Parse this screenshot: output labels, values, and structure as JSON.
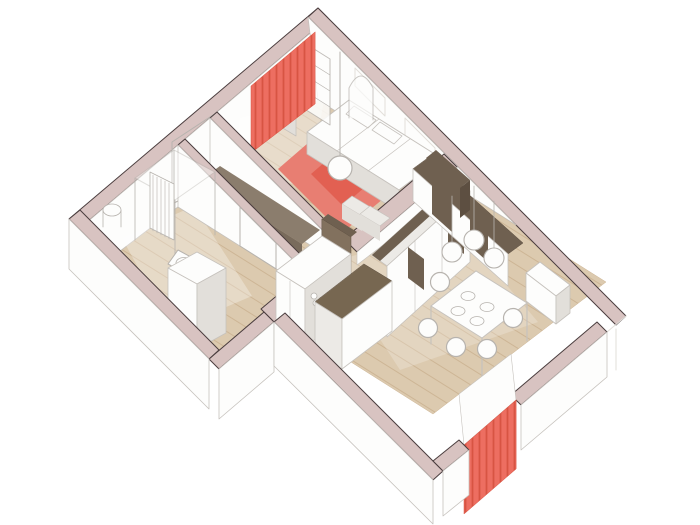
{
  "palette": {
    "wallTop": "#d8c3c1",
    "wallEdge": "#4a3d3e",
    "outline": "#c6c2bd",
    "shade": "#e2dfda",
    "lightGray": "#eceae6",
    "white": "#fdfdfc",
    "woodBase": "#dccaaf",
    "woodLine": "#cdb595",
    "rug": "#e87e72",
    "rugDark": "#e26052",
    "red": "#ed6e61",
    "redStripe": "#d85443",
    "brown": "#6f6050",
    "brownLight": "#82715e",
    "brownMid": "#5d4f41",
    "benchTop": "#8b7d6d",
    "benchFront": "#796b5c",
    "islandTop": "#776751",
    "gray": "#b7b3ae",
    "wash": "#ffffff"
  },
  "scene": [
    {
      "n": "floor-bedroom",
      "k": "poly",
      "p": "318,100 444,180 344,257 217,177",
      "f": "url(#wood)",
      "s": "$woodLine",
      "w": 0.5
    },
    {
      "n": "floor-hallway",
      "k": "poly",
      "p": "217,177 344,257 305,287 178,207",
      "f": "url(#wood)",
      "s": "$woodLine",
      "w": 0.5
    },
    {
      "n": "floor-bathroom",
      "k": "poly",
      "p": "178,207 305,287 217,354 90,274",
      "f": "url(#wood)",
      "s": "$woodLine",
      "w": 0.5
    },
    {
      "n": "floor-living-room",
      "k": "poly",
      "p": "444,180 606,282 433,414 272,312",
      "f": "url(#wood)",
      "s": "$woodLine",
      "w": 0.5
    },
    {
      "n": "wall-upper-left-top",
      "k": "poly",
      "p": "318,8 69,219 79,229 328,18",
      "f": "$wallTop",
      "s": "$wallEdge",
      "w": 1
    },
    {
      "n": "wall-upper-left-face",
      "k": "poly",
      "p": "328,18 79,229 90,274 318,100",
      "f": "$white",
      "s": "$outline",
      "w": 0.8
    },
    {
      "n": "entry-door-frame",
      "k": "poly",
      "p": "216,113 172,142 172,204 216,182",
      "f": "none",
      "s": "$gray",
      "w": 1
    },
    {
      "n": "entry-door-leaf",
      "k": "line",
      "p": "214,183 193,207",
      "s": "$gray",
      "w": 1.2
    },
    {
      "n": "wall-upper-right-top",
      "k": "poly",
      "p": "318,8 626,316 616,325 308,17",
      "f": "$wallTop",
      "s": "$wallEdge",
      "w": 1
    },
    {
      "n": "wall-upper-right-face",
      "k": "poly",
      "p": "308,17 516,225 318,100",
      "f": "$white",
      "s": "$outline",
      "w": 0.8
    },
    {
      "n": "window-frame-1",
      "k": "poly",
      "p": "355,68 385,98 385,116 355,86",
      "f": "none",
      "s": "$shade",
      "w": 1
    },
    {
      "n": "window-frame-2",
      "k": "poly",
      "p": "405,118 435,148 435,166 405,136",
      "f": "none",
      "s": "$shade",
      "w": 1
    },
    {
      "n": "corner-glass-lines",
      "k": "path",
      "p": "M626,316L607,332M616,329L616,370M600,342L600,382",
      "s": "$shade",
      "w": 1
    },
    {
      "n": "light-wash-bedroom",
      "k": "poly",
      "p": "240,118 325,95 308,188 232,168",
      "f": "$wash",
      "o": 0.35
    },
    {
      "n": "light-wash-bathroom",
      "k": "poly",
      "p": "122,238 194,206 252,296 172,330",
      "f": "$wash",
      "o": 0.3
    },
    {
      "n": "light-wash-living",
      "k": "poly",
      "p": "330,262 458,228 538,322 400,370",
      "f": "$wash",
      "o": 0.22
    },
    {
      "n": "bedroom-rug",
      "k": "poly",
      "p": "330,124 395,189 342,233 278,169",
      "f": "$rug"
    },
    {
      "n": "bedroom-rug-accent",
      "k": "poly",
      "p": "333,155 365,187 343,206 311,174",
      "f": "$rugDark"
    },
    {
      "n": "bed-top",
      "k": "poly",
      "p": "349,100 441,158 399,190 307,132",
      "f": "$white",
      "s": "$outline",
      "w": 1
    },
    {
      "n": "bed-front",
      "k": "poly",
      "p": "307,132 399,190 399,212 307,154",
      "f": "$shade",
      "s": "$outline",
      "w": 0.8
    },
    {
      "n": "bed-pillow-1",
      "k": "poly",
      "p": "354,106 376,120 368,128 346,114",
      "f": "$white",
      "s": "$outline",
      "w": 0.8
    },
    {
      "n": "bed-pillow-2",
      "k": "poly",
      "p": "380,122 402,136 394,144 372,130",
      "f": "$white",
      "s": "$outline",
      "w": 0.8
    },
    {
      "n": "bed-cushion-seams",
      "k": "path",
      "p": "M379,119L337,151M410,139L368,171",
      "s": "$outline",
      "w": 0.7
    },
    {
      "n": "bookshelf-frame",
      "k": "poly",
      "p": "303,42 330,59 330,125 303,108",
      "f": "$white",
      "s": "$gray",
      "w": 1,
      "o": 0.85
    },
    {
      "n": "bookshelf-shelves",
      "k": "path",
      "p": "M303,58L330,75M303,74L330,91M303,90L330,107",
      "s": "$gray",
      "w": 0.7
    },
    {
      "n": "floor-mirror",
      "k": "path",
      "p": "M349,118L349,88Q361,64 373,88L373,120",
      "f": "$white",
      "s": "$gray",
      "w": 1,
      "o": 0.7
    },
    {
      "n": "dresser-top",
      "k": "poly",
      "p": "286,94 306,106 296,114 276,102",
      "f": "$white",
      "s": "$outline",
      "w": 0.8
    },
    {
      "n": "dresser-front",
      "k": "poly",
      "p": "276,102 296,114 296,136 276,124",
      "f": "$shade",
      "s": "$outline",
      "w": 0.8
    },
    {
      "n": "bedroom-curtain",
      "k": "poly",
      "p": "315,32 251,86 251,153 315,104",
      "f": "url(#curt)",
      "s": "$redStripe",
      "w": 0.5
    },
    {
      "n": "bedroom-pendant-cord",
      "k": "line",
      "p": "340,52 340,156",
      "s": "$gray",
      "w": 1
    },
    {
      "n": "bedroom-pendant-lamp",
      "k": "circle",
      "p": "340,168 12",
      "f": "$white",
      "s": "$gray",
      "w": 1.2
    },
    {
      "n": "wall-bedroom-hallway-top",
      "k": "poly",
      "p": "217,112 344,239 337,245 210,118",
      "f": "$wallTop",
      "s": "$wallEdge",
      "w": 1
    },
    {
      "n": "wall-bedroom-hallway-face",
      "k": "poly",
      "p": "210,118 337,245 337,262 210,182",
      "f": "$white",
      "s": "$outline",
      "w": 0.8
    },
    {
      "n": "hallway-bench-top",
      "k": "poly",
      "p": "220,166 320,230 302,244 201,180",
      "f": "$benchTop"
    },
    {
      "n": "hallway-bench-front",
      "k": "poly",
      "p": "201,180 302,244 302,269 201,205",
      "f": "$benchFront"
    },
    {
      "n": "wall-hallway-bath-top",
      "k": "poly",
      "p": "185,139 312,266 305,272 178,145",
      "f": "$wallTop",
      "s": "$wallEdge",
      "w": 1
    },
    {
      "n": "wall-hallway-bath-face",
      "k": "poly",
      "p": "178,145 305,272 305,287 178,207",
      "f": "$white",
      "s": "$outline",
      "w": 0.8
    },
    {
      "n": "bathroom-door-frame",
      "k": "poly",
      "p": "240,207 276,243 276,269 240,246",
      "f": "none",
      "s": "$gray",
      "w": 1
    },
    {
      "n": "shower-top-frame",
      "k": "poly",
      "p": "174,150 215,172 175,200 135,178",
      "f": "$white",
      "s": "$gray",
      "w": 1,
      "o": 0.4
    },
    {
      "n": "shower-glass-edges",
      "k": "path",
      "p": "M174,150L174,210M215,172L215,235M175,200L175,266M135,178L135,240",
      "s": "$gray",
      "w": 0.8
    },
    {
      "n": "bathroom-radiator",
      "k": "poly",
      "p": "150,172 174,184 174,240 150,228",
      "f": "$white",
      "s": "$gray",
      "w": 0.8
    },
    {
      "n": "bathroom-radiator-slats",
      "k": "path",
      "p": "M153,175L153,231M157,177L157,233M161,179L161,235M165,181L165,237M169,183L169,239",
      "s": "$gray",
      "w": 0.6
    },
    {
      "n": "water-heater-body",
      "k": "path",
      "p": "M103,210L103,227M121,210L121,227",
      "s": "$gray",
      "w": 0.8
    },
    {
      "n": "water-heater-top",
      "k": "ellipse",
      "p": "112,210 9 6",
      "f": "$white",
      "s": "$gray",
      "w": 0.8
    },
    {
      "n": "toilet",
      "k": "poly",
      "p": "178,250 200,262 190,276 168,264",
      "f": "$white",
      "s": "$gray",
      "w": 1
    },
    {
      "n": "toilet-seat",
      "k": "ellipse",
      "p": "184,263 8 5.5",
      "f": "$white",
      "s": "$gray",
      "w": 0.8
    },
    {
      "n": "bidet",
      "k": "poly",
      "p": "200,280 222,292 212,306 190,294",
      "f": "$white",
      "s": "$gray",
      "w": 1
    },
    {
      "n": "bidet-seat",
      "k": "ellipse",
      "p": "206,293 8 5.5",
      "f": "$white",
      "s": "$gray",
      "w": 0.8
    },
    {
      "n": "bath-cabinet-top",
      "k": "poly",
      "p": "168,268 197,252 226,268 197,284",
      "f": "$white",
      "s": "$outline",
      "w": 0.8
    },
    {
      "n": "bath-cabinet-left",
      "k": "poly",
      "p": "168,268 197,284 197,349 168,333",
      "f": "$white",
      "s": "$outline",
      "w": 0.8
    },
    {
      "n": "bath-cabinet-right",
      "k": "poly",
      "p": "197,284 226,268 226,333 197,349",
      "f": "$shade",
      "s": "$outline",
      "w": 0.8
    },
    {
      "n": "wall-strip-living-top",
      "k": "poly",
      "p": "444,154 344,239 357,252 457,167",
      "f": "$wallTop",
      "s": "$wallEdge",
      "w": 1
    },
    {
      "n": "wall-strip-living-face",
      "k": "poly",
      "p": "457,167 357,252 357,265 457,188",
      "f": "$white",
      "s": "$outline",
      "w": 0.6
    },
    {
      "n": "wardrobe-top",
      "k": "poly",
      "p": "455,180 470,191 387,266 372,255",
      "f": "$lightGray",
      "s": "$outline",
      "w": 0.8
    },
    {
      "n": "wardrobe-top-accent",
      "k": "poly",
      "p": "455,180 463,186 380,261 372,255",
      "f": "$brown"
    },
    {
      "n": "wardrobe-front",
      "k": "poly",
      "p": "470,191 387,266 387,337 470,262",
      "f": "$white",
      "s": "$outline",
      "w": 0.8
    },
    {
      "n": "wardrobe-door-seams",
      "k": "path",
      "p": "M442,216L442,287M415,240L415,312",
      "s": "$outline",
      "w": 0.6
    },
    {
      "n": "wardrobe-panel-1",
      "k": "poly",
      "p": "448,210 464,222 464,254 448,242",
      "f": "$brown"
    },
    {
      "n": "wardrobe-panel-2",
      "k": "poly",
      "p": "408,247 424,259 424,290 408,278",
      "f": "$brown"
    },
    {
      "n": "media-unit-top",
      "k": "poly",
      "p": "428,158 523,243 508,254 413,169",
      "f": "$brown",
      "s": "$brownMid",
      "w": 0.5
    },
    {
      "n": "media-unit-front",
      "k": "poly",
      "p": "413,169 508,254 508,286 413,201",
      "f": "$white",
      "s": "$outline",
      "w": 0.8
    },
    {
      "n": "media-panel-1",
      "k": "poly",
      "p": "432,185 452,203 452,232 432,214",
      "f": "$brown"
    },
    {
      "n": "media-panel-2",
      "k": "poly",
      "p": "470,219 488,235 488,262 470,246",
      "f": "$brown"
    },
    {
      "n": "media-hutch-top",
      "k": "poly",
      "p": "436,150 470,180 460,188 426,158",
      "f": "$brown"
    },
    {
      "n": "media-hutch-side",
      "k": "poly",
      "p": "470,180 460,188 460,218 470,210",
      "f": "$brownMid"
    },
    {
      "n": "wall-kitchen-bath-top",
      "k": "poly",
      "p": "305,272 261,309 274,322 318,285",
      "f": "$wallTop",
      "s": "$wallEdge",
      "w": 1
    },
    {
      "n": "wall-kitchen-bath-face",
      "k": "poly",
      "p": "318,285 274,322 274,328 318,295",
      "f": "$white",
      "s": "$outline",
      "w": 0.6
    },
    {
      "n": "kitchen-tall-unit-top",
      "k": "poly",
      "p": "328,214 357,232 351,237 322,219",
      "f": "$brown"
    },
    {
      "n": "kitchen-tall-unit-front",
      "k": "poly",
      "p": "322,219 351,237 351,312 322,294",
      "f": "$brownLight",
      "s": "$brownMid",
      "w": 0.5
    },
    {
      "n": "kitchen-cabinets-top",
      "k": "poly",
      "p": "322,236 351,254 305,289 276,271",
      "f": "$white",
      "s": "$outline",
      "w": 0.8
    },
    {
      "n": "kitchen-cabinets-front",
      "k": "poly",
      "p": "276,271 305,289 305,347 276,329",
      "f": "$white",
      "s": "$outline",
      "w": 0.8
    },
    {
      "n": "kitchen-cabinets-side",
      "k": "poly",
      "p": "351,254 305,289 305,347 351,312",
      "f": "$shade",
      "s": "$outline",
      "w": 0.6
    },
    {
      "n": "kitchen-cabinet-seam",
      "k": "path",
      "p": "M290,281L290,339",
      "s": "$outline",
      "w": 0.6
    },
    {
      "n": "cooktop-burner-1",
      "k": "circle",
      "p": "314,296 3",
      "f": "$white",
      "s": "$gray",
      "w": 0.8
    },
    {
      "n": "cooktop-burner-2",
      "k": "circle",
      "p": "322,300 3",
      "f": "$white",
      "s": "$gray",
      "w": 0.8
    },
    {
      "n": "cooktop-burner-3",
      "k": "circle",
      "p": "316,303 3",
      "f": "$white",
      "s": "$gray",
      "w": 0.8
    },
    {
      "n": "cooktop-burner-4",
      "k": "circle",
      "p": "324,307 3",
      "f": "$white",
      "s": "$gray",
      "w": 0.8
    },
    {
      "n": "island-top",
      "k": "poly",
      "p": "364,264 392,281 342,319 315,302",
      "f": "$islandTop",
      "s": "$brownMid",
      "w": 0.5
    },
    {
      "n": "island-front",
      "k": "poly",
      "p": "315,302 342,319 342,369 315,352",
      "f": "$lightGray",
      "s": "$outline",
      "w": 0.8
    },
    {
      "n": "island-side",
      "k": "poly",
      "p": "392,281 342,319 342,369 392,331",
      "f": "$white",
      "s": "$outline",
      "w": 0.8
    },
    {
      "n": "pouf-1-top",
      "k": "poly",
      "p": "352,196 372,208 362,216 342,204",
      "f": "$lightGray",
      "s": "$outline",
      "w": 0.7
    },
    {
      "n": "pouf-1-front",
      "k": "poly",
      "p": "342,204 362,216 362,231 342,219",
      "f": "$shade"
    },
    {
      "n": "pouf-2-top",
      "k": "poly",
      "p": "370,206 390,218 380,226 360,214",
      "f": "$lightGray",
      "s": "$outline",
      "w": 0.7
    },
    {
      "n": "pouf-2-front",
      "k": "poly",
      "p": "360,214 380,226 380,241 360,229",
      "f": "$shade"
    },
    {
      "n": "sideboard-top",
      "k": "poly",
      "p": "540,262 570,285 556,296 526,273",
      "f": "$white",
      "s": "$outline",
      "w": 0.8
    },
    {
      "n": "sideboard-front",
      "k": "poly",
      "p": "526,273 556,296 556,324 526,301",
      "f": "$white",
      "s": "$outline",
      "w": 0.8
    },
    {
      "n": "sideboard-side",
      "k": "poly",
      "p": "570,285 556,296 556,324 570,313",
      "f": "$shade",
      "s": "$outline",
      "w": 0.8
    },
    {
      "n": "dining-table-legs",
      "k": "path",
      "p": "M476,271L476,309M527,303L527,341M482,338L482,376M431,306L431,344",
      "s": "$outline",
      "w": 1.2
    },
    {
      "n": "dining-table-top",
      "k": "poly",
      "p": "476,271 527,303 482,338 431,306",
      "f": "$white",
      "s": "$outline",
      "w": 1
    },
    {
      "n": "table-plate-1",
      "k": "ellipse",
      "p": "468,296 7 4.5",
      "f": "$white",
      "s": "$gray",
      "w": 0.8
    },
    {
      "n": "table-plate-2",
      "k": "ellipse",
      "p": "487,307 7 4.5",
      "f": "$white",
      "s": "$gray",
      "w": 0.8
    },
    {
      "n": "table-plate-3",
      "k": "ellipse",
      "p": "458,311 7 4.5",
      "f": "$white",
      "s": "$gray",
      "w": 0.8
    },
    {
      "n": "table-plate-4",
      "k": "ellipse",
      "p": "477,321 7 4.5",
      "f": "$white",
      "s": "$gray",
      "w": 0.8
    },
    {
      "n": "dining-chair-1",
      "k": "circle",
      "p": "428,328 9.5",
      "f": "$white",
      "s": "$gray",
      "w": 1.2
    },
    {
      "n": "dining-chair-2",
      "k": "circle",
      "p": "456,347 9.5",
      "f": "$white",
      "s": "$gray",
      "w": 1.2
    },
    {
      "n": "dining-chair-3",
      "k": "circle",
      "p": "487,349 9.5",
      "f": "$white",
      "s": "$gray",
      "w": 1.2
    },
    {
      "n": "dining-chair-4",
      "k": "circle",
      "p": "513,318 9.5",
      "f": "$white",
      "s": "$gray",
      "w": 1.2
    },
    {
      "n": "dining-chair-5",
      "k": "circle",
      "p": "440,282 9.5",
      "f": "$white",
      "s": "$gray",
      "w": 1.2
    },
    {
      "n": "dining-pendant-cords",
      "k": "path",
      "p": "M452,196L452,242M474,186L474,230M494,201L494,248",
      "s": "$gray",
      "w": 0.8
    },
    {
      "n": "dining-pendant-lamp-1",
      "k": "circle",
      "p": "452,252 10",
      "f": "$white",
      "s": "$gray",
      "w": 1.1
    },
    {
      "n": "dining-pendant-lamp-2",
      "k": "circle",
      "p": "474,240 10",
      "f": "$white",
      "s": "$gray",
      "w": 1.1
    },
    {
      "n": "dining-pendant-lamp-3",
      "k": "circle",
      "p": "494,258 10",
      "f": "$white",
      "s": "$gray",
      "w": 1.1
    },
    {
      "n": "wall-notch-top",
      "k": "poly",
      "p": "209,359 264,312 274,322 219,369",
      "f": "$wallTop",
      "s": "$wallEdge",
      "w": 1
    },
    {
      "n": "wall-notch-face",
      "k": "poly",
      "p": "219,369 274,322 274,372 219,419",
      "f": "$white",
      "s": "$outline",
      "w": 0.8
    },
    {
      "n": "wall-lower-left-top",
      "k": "poly",
      "p": "69,219 209,359 219,350 80,210",
      "f": "$wallTop",
      "s": "$wallEdge",
      "w": 1
    },
    {
      "n": "wall-lower-left-face",
      "k": "poly",
      "p": "69,219 209,359 209,409 69,269",
      "f": "$white",
      "s": "$outline",
      "w": 0.8
    },
    {
      "n": "wall-lower-front-top",
      "k": "poly",
      "p": "285,313 443,471 433,480 274,322",
      "f": "$wallTop",
      "s": "$wallEdge",
      "w": 1
    },
    {
      "n": "wall-lower-front-face",
      "k": "poly",
      "p": "274,322 433,480 433,524 274,366",
      "f": "$white",
      "s": "$outline",
      "w": 0.8
    },
    {
      "n": "wall-lower-right-top-a",
      "k": "poly",
      "p": "597,322 511,395 521,405 607,332",
      "f": "$wallTop",
      "s": "$wallEdge",
      "w": 1
    },
    {
      "n": "wall-lower-right-face-a",
      "k": "poly",
      "p": "607,332 521,405 521,450 607,377",
      "f": "$white",
      "s": "$outline",
      "w": 0.8
    },
    {
      "n": "window-sill",
      "k": "poly",
      "p": "511,354 459,394 464,445 516,400",
      "f": "$white",
      "s": "$outline",
      "w": 0.6
    },
    {
      "n": "dining-curtain",
      "k": "poly",
      "p": "516,400 464,445 464,514 516,469",
      "f": "url(#curt)",
      "s": "$redStripe",
      "w": 0.5
    },
    {
      "n": "wall-lower-right-top-b",
      "k": "poly",
      "p": "459,440 433,461 443,471 469,450",
      "f": "$wallTop",
      "s": "$wallEdge",
      "w": 1
    },
    {
      "n": "wall-lower-right-face-b",
      "k": "poly",
      "p": "469,450 443,471 443,516 469,495",
      "f": "$white",
      "s": "$outline",
      "w": 0.8
    }
  ]
}
